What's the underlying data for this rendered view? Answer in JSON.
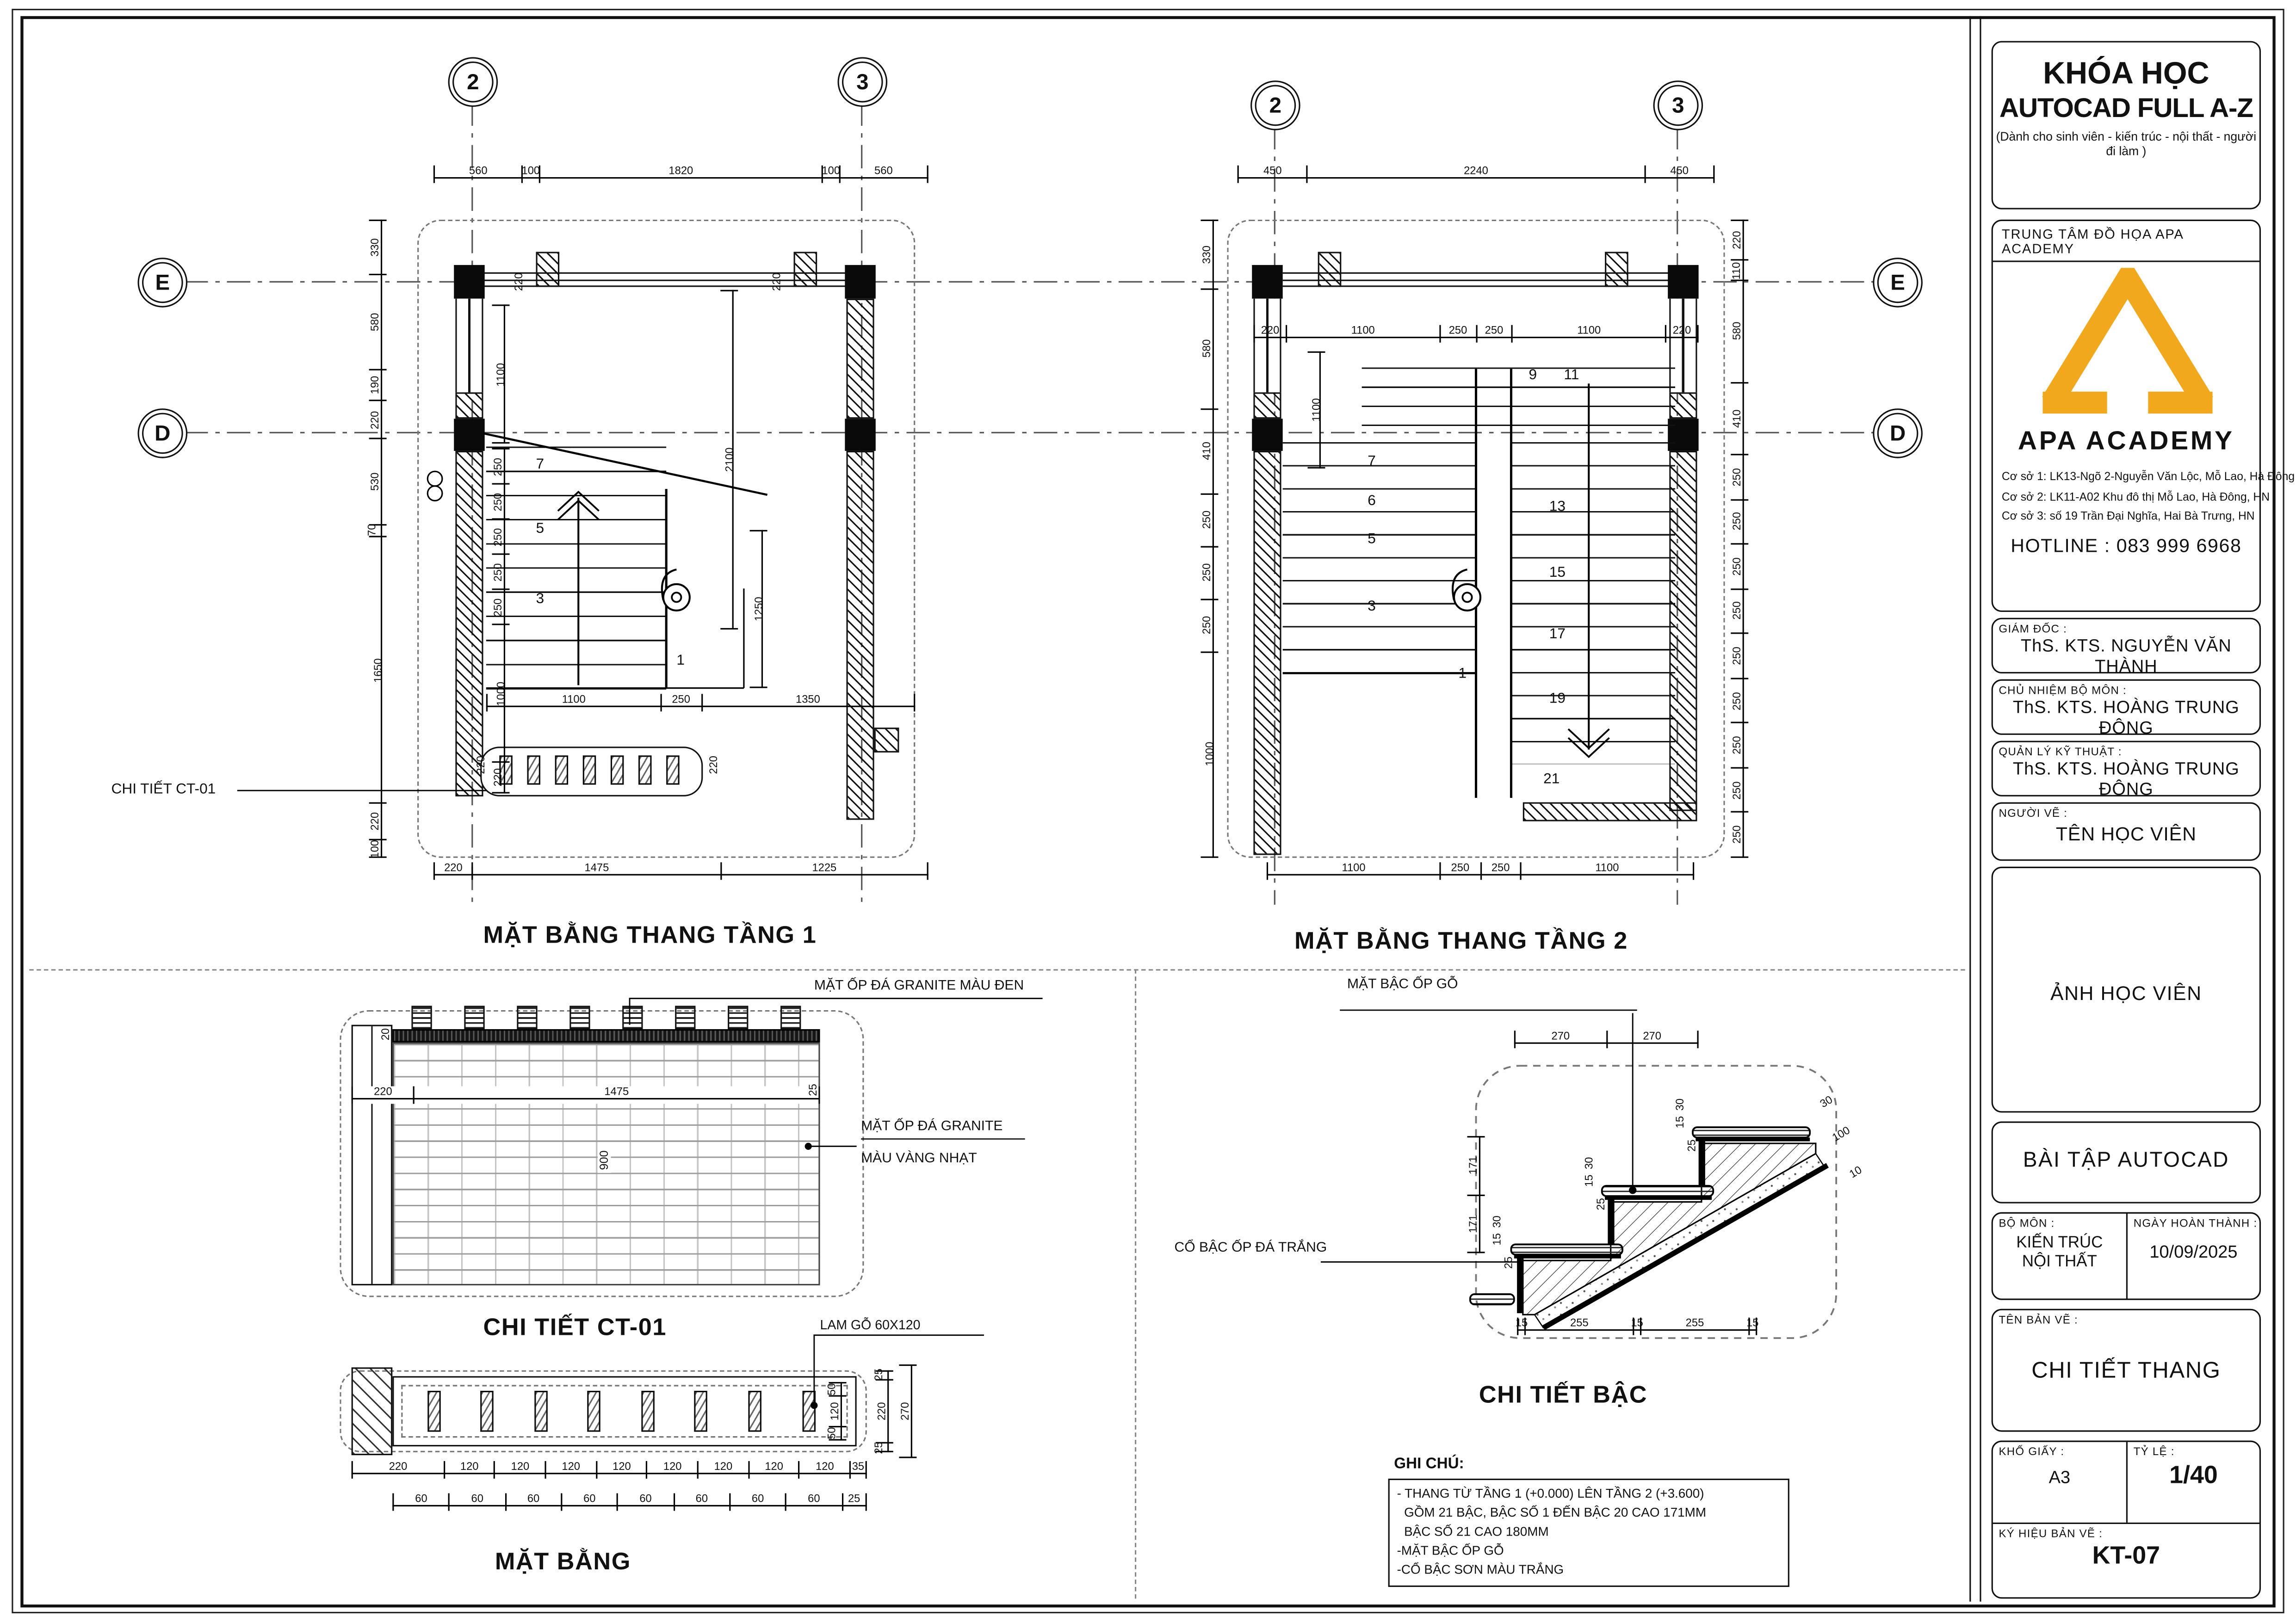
{
  "colors": {
    "accent": "#F2A81D",
    "ink": "#111111"
  },
  "title_block": {
    "course": {
      "line1": "KHÓA HỌC",
      "line2": "AUTOCAD FULL A-Z",
      "subtitle": "(Dành cho sinh viên  - kiến trúc - nội thất - người đi làm )"
    },
    "center_label": "TRUNG TÂM ĐỒ HỌA APA ACADEMY",
    "logo_name": "APA ACADEMY",
    "addresses": [
      "Cơ sở 1: LK13-Ngõ 2-Nguyễn Văn Lộc, Mỗ Lao, Hà Đông",
      "Cơ sở 2: LK11-A02 Khu đô thị Mỗ Lao, Hà Đông, HN",
      "Cơ sở 3: số 19 Trần Đại Nghĩa, Hai Bà Trưng, HN"
    ],
    "hotline": "HOTLINE : 083 999 6968",
    "fields": [
      {
        "label": "GIÁM ĐỐC :",
        "value": "ThS. KTS. NGUYỄN VĂN THÀNH"
      },
      {
        "label": "CHỦ NHIỆM BỘ MÔN :",
        "value": "ThS. KTS. HOÀNG TRUNG ĐÔNG"
      },
      {
        "label": "QUẢN LÝ KỸ THUẬT :",
        "value": "ThS. KTS. HOÀNG TRUNG ĐÔNG"
      },
      {
        "label": "NGƯỜI VẼ :",
        "value": "TÊN HỌC VIÊN"
      }
    ],
    "photo_text": "ẢNH HỌC VIÊN",
    "exercise": "BÀI TẬP AUTOCAD",
    "subject_label": "BỘ MÔN :",
    "subject_value": "KIẾN TRÚC NỘI THẤT",
    "date_label": "NGÀY HOÀN THÀNH :",
    "date_value": "10/09/2025",
    "drawing_name_label": "TÊN BẢN VẼ :",
    "drawing_name_value": "CHI TIẾT THANG",
    "paper_label": "KHỔ GIẤY :",
    "paper_value": "A3",
    "scale_label": "TỶ LỆ :",
    "scale_value": "1/40",
    "code_label": "KÝ HIỆU BẢN VẼ :",
    "code_value": "KT-07"
  },
  "plan1": {
    "title": "MẶT BẰNG THANG TẦNG 1",
    "axis_2": "2",
    "axis_3": "3",
    "axis_E": "E",
    "axis_D": "D",
    "dims_top": [
      "560",
      "100",
      "1820",
      "100",
      "560"
    ],
    "dims_bottom": [
      "220",
      "1475",
      "1225"
    ],
    "dims_left": [
      "330",
      "580",
      "190",
      "220",
      "530",
      "70",
      "1650",
      "220",
      "100"
    ],
    "dims_inner_left": [
      "250",
      "250",
      "250",
      "250",
      "250",
      "1000",
      "220"
    ],
    "dim_1100v": [
      "1100"
    ],
    "dim_2100v": [
      "2100"
    ],
    "dim_1250v": [
      "1250"
    ],
    "dims_inner_bottom": [
      "1100",
      "250",
      "1350"
    ],
    "wall_dim": "220",
    "treads": [
      "7",
      "5",
      "3",
      "1"
    ],
    "callout": "CHI TIẾT CT-01"
  },
  "plan2": {
    "title": "MẶT BẰNG THANG TẦNG 2",
    "axis_2": "2",
    "axis_3": "3",
    "axis_E": "E",
    "axis_D": "D",
    "dims_top": [
      "450",
      "2240",
      "450"
    ],
    "dims_top_inner": [
      "220",
      "1100",
      "250",
      "250",
      "1100",
      "220"
    ],
    "dims_bottom": [
      "1100",
      "250",
      "250",
      "1100"
    ],
    "dims_left": [
      "330",
      "580",
      "410",
      "250",
      "250",
      "250",
      "1000"
    ],
    "dims_right": [
      "220",
      "110",
      "580",
      "410",
      "250",
      "250",
      "250",
      "250",
      "250",
      "250",
      "250",
      "250",
      "250"
    ],
    "dim_1100v": [
      "1100"
    ],
    "treads_left": [
      "7",
      "6",
      "5",
      "3",
      "1"
    ],
    "treads_right": [
      "9",
      "11",
      "13",
      "15",
      "17",
      "19",
      "21"
    ]
  },
  "ct01": {
    "title": "CHI TIẾT CT-01",
    "label_top": "MẶT ỐP ĐÁ GRANITE MÀU ĐEN",
    "label_right1": "MẶT ỐP ĐÁ GRANITE",
    "label_right2": "MÀU VÀNG NHẠT",
    "dims_width": [
      "220",
      "1475"
    ],
    "dim_900": "900",
    "dim_25": "25",
    "dim_20": "20"
  },
  "ct01_plan": {
    "title": "MẶT BẰNG",
    "label": "LAM GỖ 60X120",
    "dims_row1": [
      "220",
      "120",
      "120",
      "120",
      "120",
      "120",
      "120",
      "120",
      "120",
      "35"
    ],
    "dims_row2": [
      "60",
      "60",
      "60",
      "60",
      "60",
      "60",
      "60",
      "60",
      "25"
    ],
    "dims_right": [
      "25",
      "220",
      "25"
    ],
    "dim_270": [
      "270"
    ],
    "dims_inner_right": [
      "50",
      "120",
      "50"
    ]
  },
  "step_detail": {
    "title": "CHI TIẾT BẬC",
    "label_top": "MẶT BẬC ỐP GỖ",
    "label_left": "CỔ BẬC ỐP ĐÁ TRẮNG",
    "dims_top": [
      "270",
      "270"
    ],
    "dims_left": [
      "171",
      "171"
    ],
    "nose_dims": [
      "30",
      "15",
      "25"
    ],
    "slope_dims": [
      "30",
      "100",
      "10"
    ],
    "dims_bottom": [
      "15",
      "255",
      "15",
      "255",
      "15"
    ]
  },
  "notes": {
    "heading": "GHI CHÚ:",
    "lines": [
      "- THANG TỪ TẦNG 1 (+0.000) LÊN TẦNG 2 (+3.600)",
      "  GỒM 21 BẬC, BẬC SỐ 1 ĐẾN BẬC 20 CAO 171MM",
      "  BẬC SỐ 21 CAO 180MM",
      "-MẶT BẬC ỐP GỖ",
      "-CỔ BẬC SƠN MÀU TRẮNG"
    ]
  }
}
